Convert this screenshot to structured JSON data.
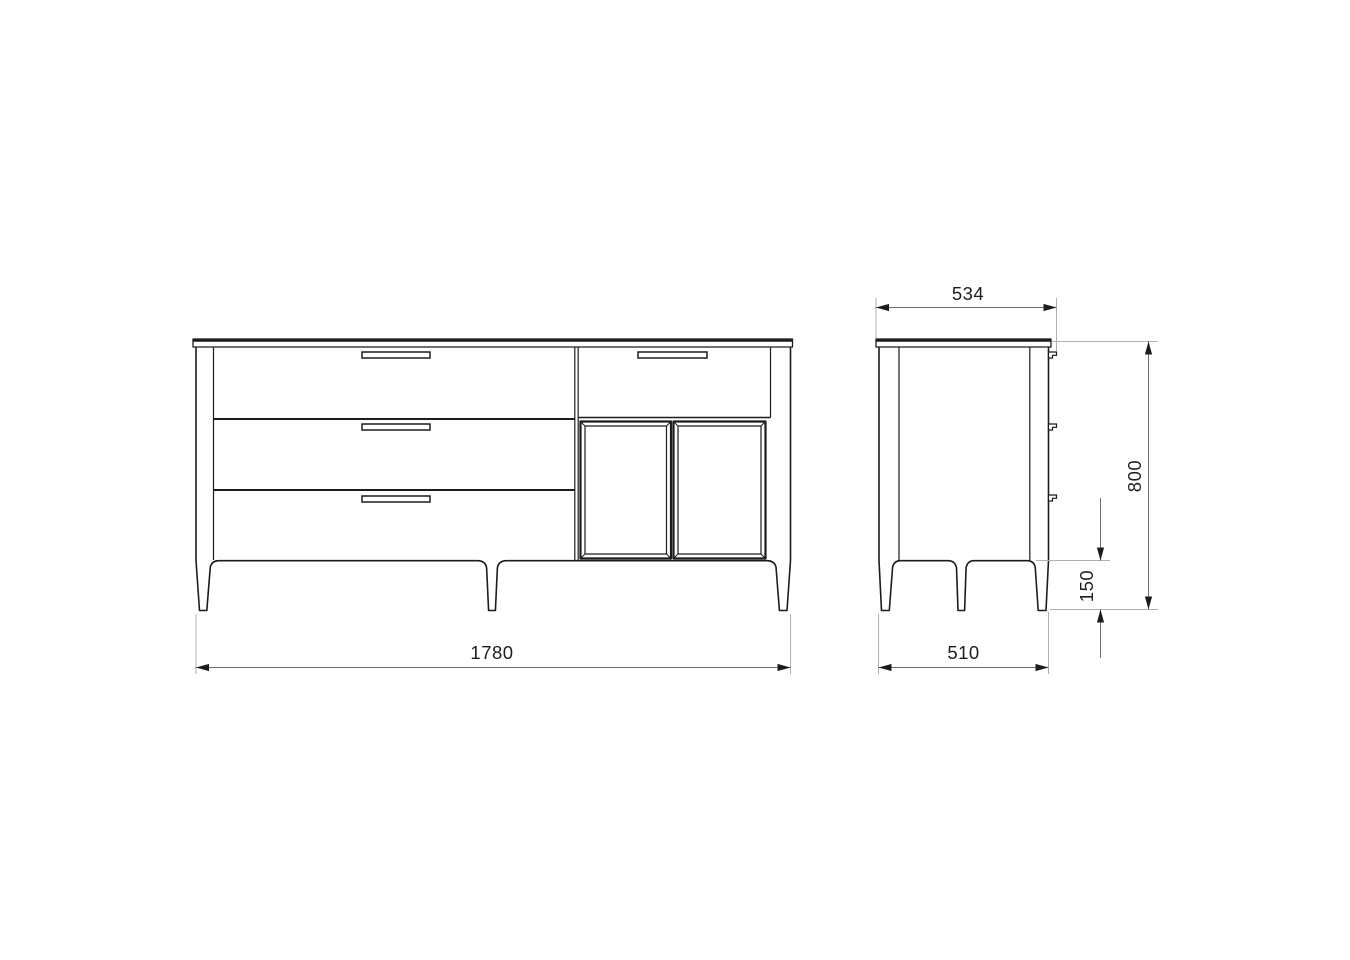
{
  "drawing": {
    "subject": "sideboard-technical-drawing",
    "views": {
      "front": {
        "name": "front view"
      },
      "side": {
        "name": "side view"
      }
    }
  },
  "dimensions": {
    "front_width": "1780",
    "side_top_depth": "534",
    "side_height": "800",
    "side_leg_height": "150",
    "side_bottom_depth": "510"
  },
  "colors": {
    "background": "#ffffff",
    "outline": "#1c1c1c",
    "dimension": "#6e6e6e",
    "extension": "#b0b0b0",
    "text": "#1d1d1d"
  }
}
